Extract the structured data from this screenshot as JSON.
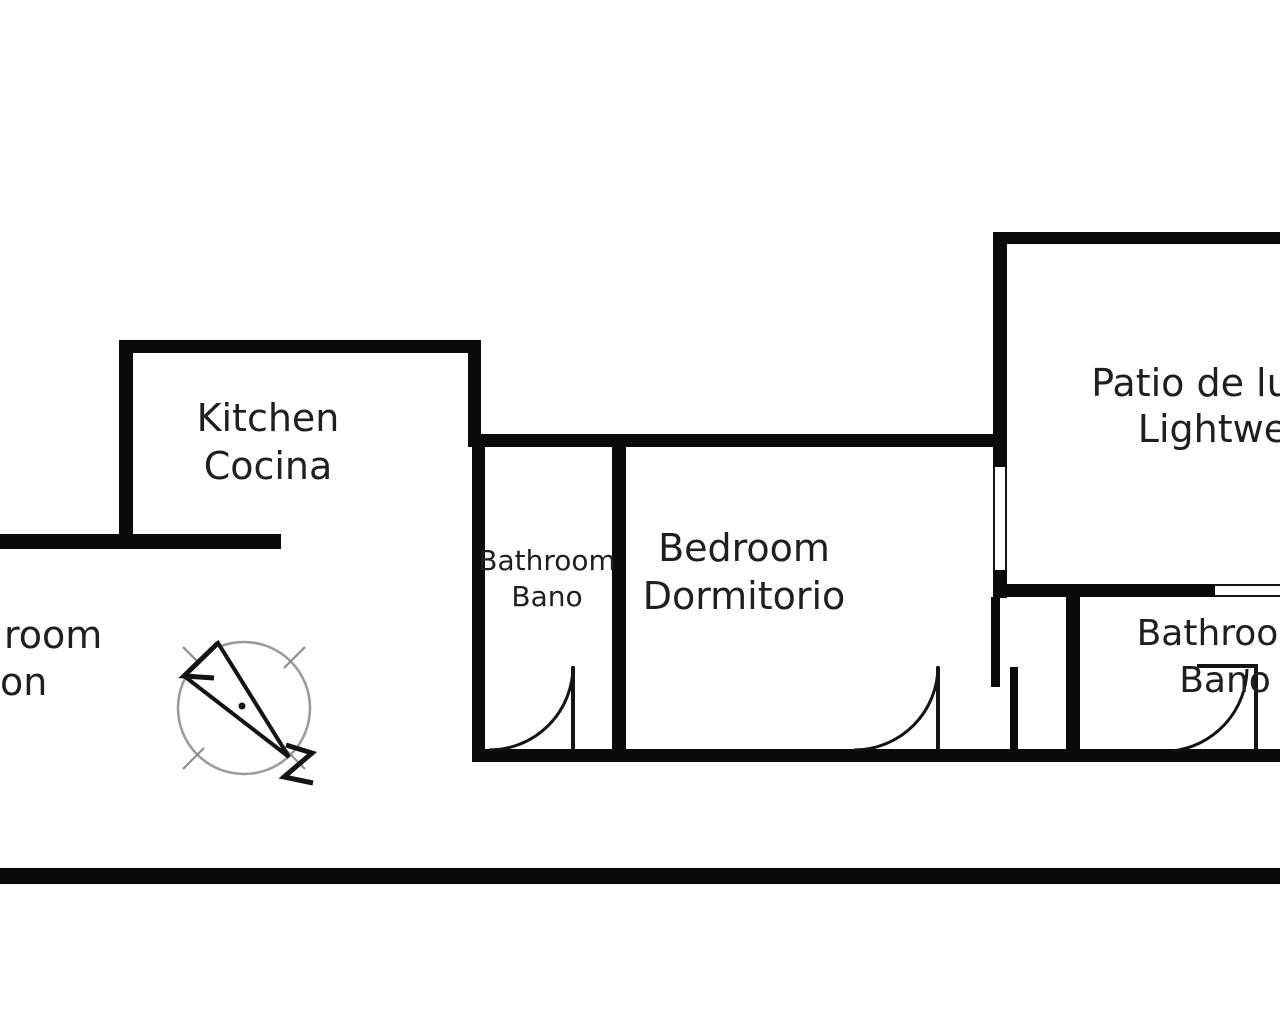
{
  "meta": {
    "type": "apartment-floor-plan",
    "width_px": 1280,
    "height_px": 1024
  },
  "colors": {
    "wall": "#0a0a0a",
    "text": "#1f1f1f",
    "bg": "#ffffff",
    "ring": "#9a9a9a"
  },
  "rooms": {
    "kitchen": {
      "line1": "Kitchen",
      "line2": "Cocina"
    },
    "bathroom_left": {
      "line1": "Bathroom",
      "line2": "Bano"
    },
    "bedroom": {
      "line1": "Bedroom",
      "line2": "Dormitorio"
    },
    "patio": {
      "line1": "Patio de luces",
      "line2": "Lightwell"
    },
    "bathroom_right": {
      "line1": "Bathroom",
      "line2": "Bano"
    },
    "living_room_clipped": {
      "line1": "room",
      "line2": "on"
    }
  },
  "icons": {
    "compass": "north-arrow-compass"
  }
}
